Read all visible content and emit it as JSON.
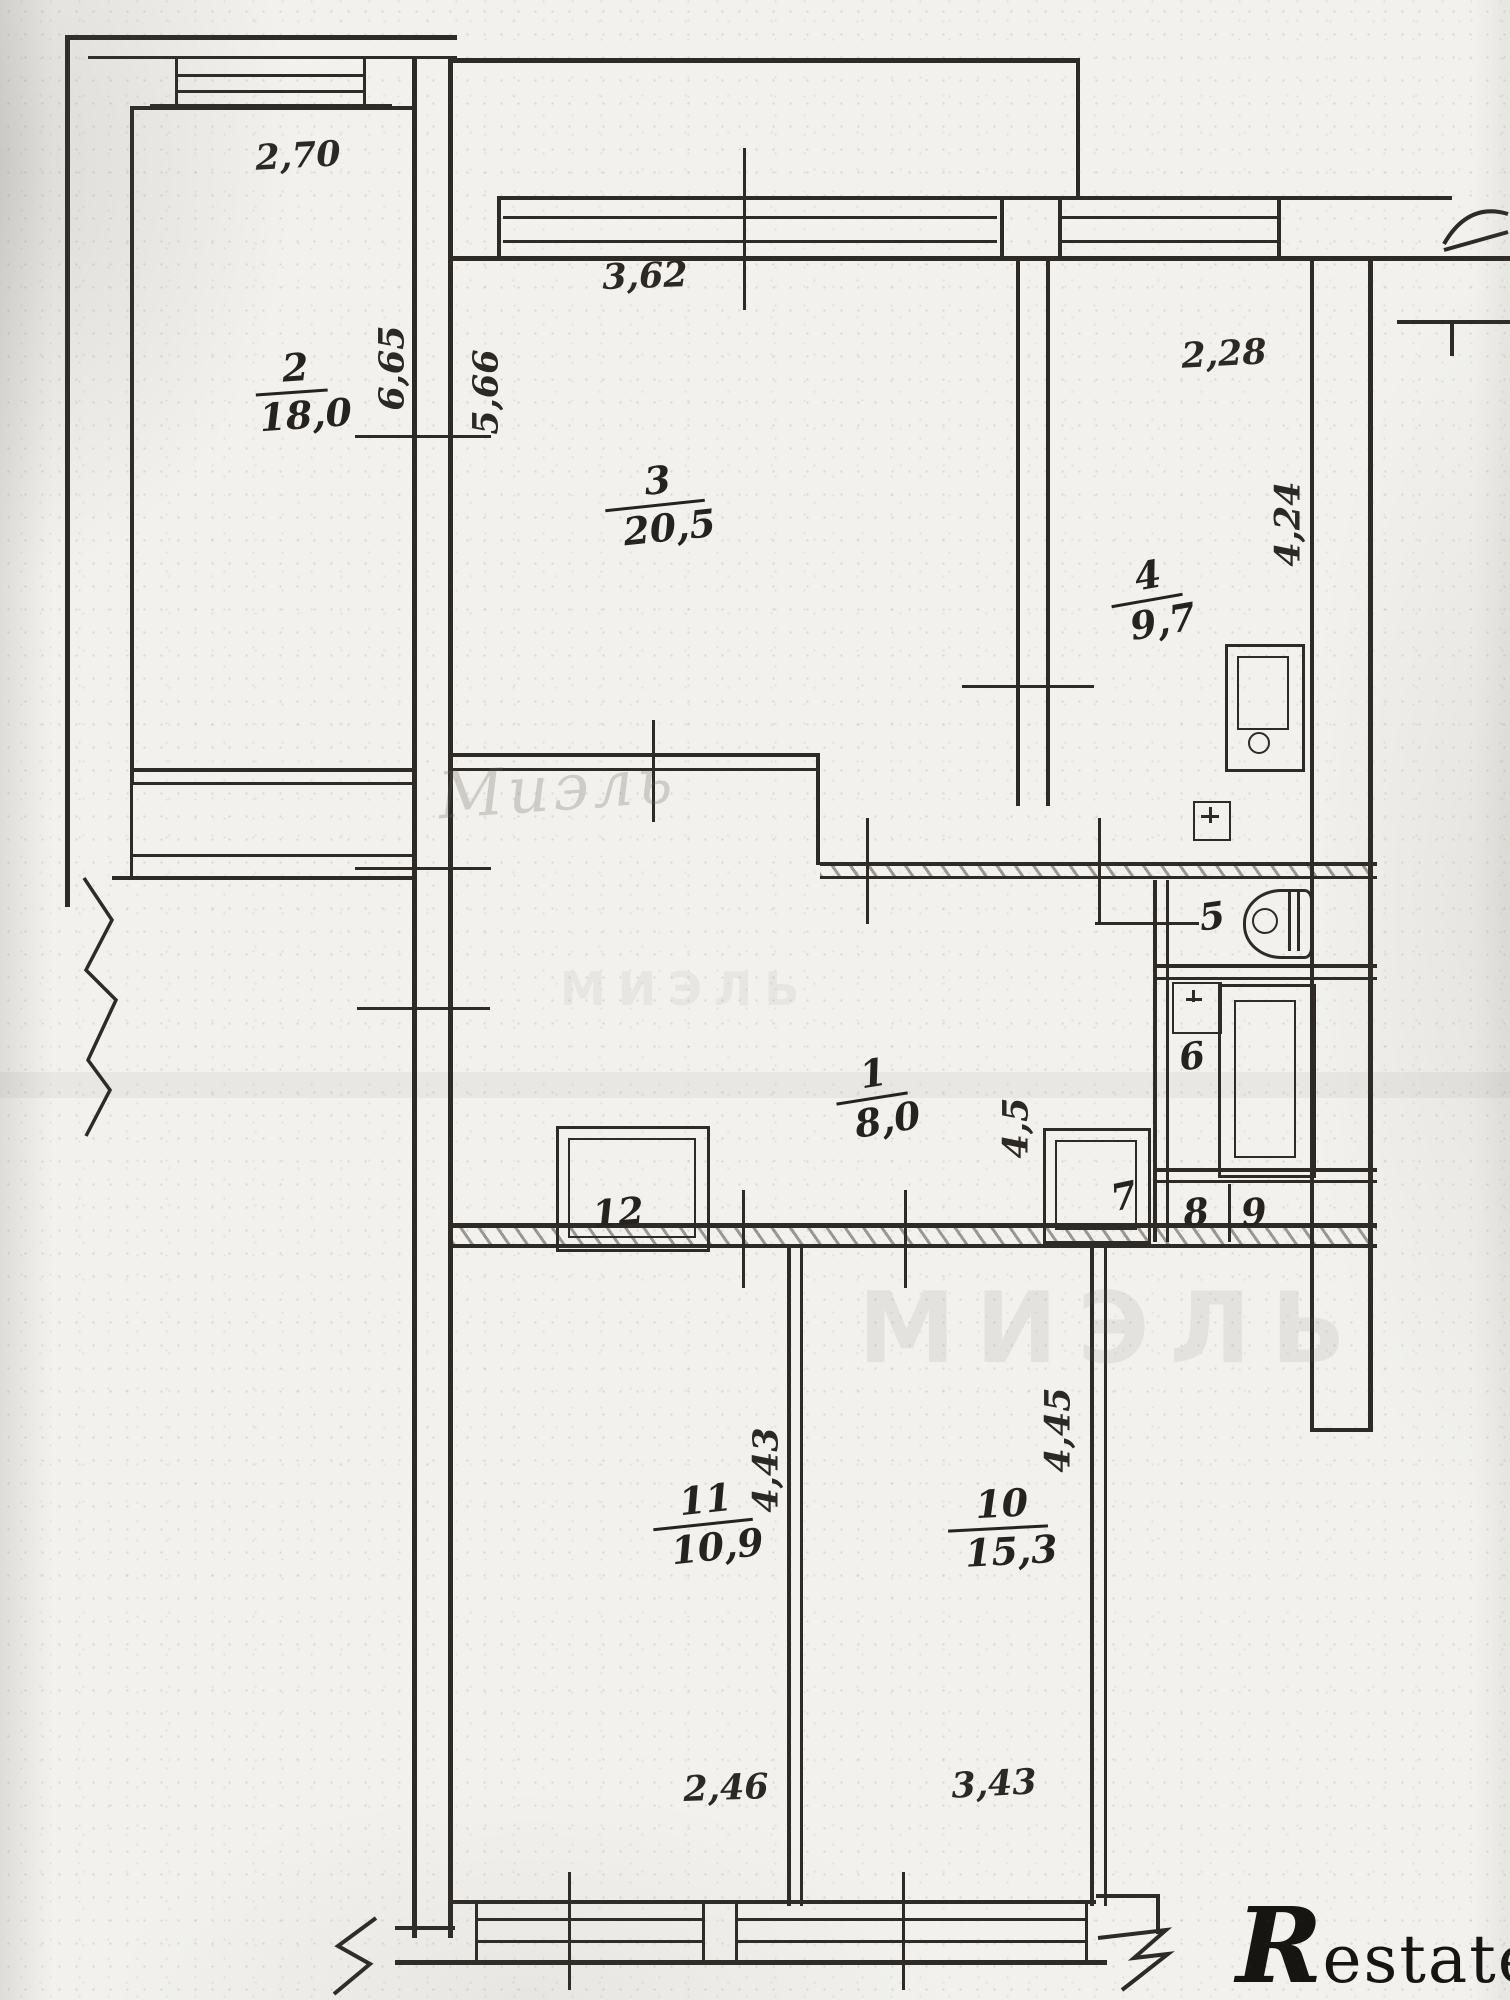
{
  "plan": {
    "kind": "apartment floor plan (scanned, hand-drawn)",
    "colors": {
      "paper": "#f2f1ed",
      "ink": "#2e2b27",
      "watermark": "#6e6962"
    }
  },
  "rooms": [
    {
      "number": "1",
      "area": "8,0"
    },
    {
      "number": "2",
      "area": "18,0"
    },
    {
      "number": "3",
      "area": "20,5"
    },
    {
      "number": "4",
      "area": "9,7"
    },
    {
      "number": "5",
      "area": ""
    },
    {
      "number": "6",
      "area": ""
    },
    {
      "number": "7",
      "area": ""
    },
    {
      "number": "8",
      "area": ""
    },
    {
      "number": "9",
      "area": ""
    },
    {
      "number": "10",
      "area": "15,3"
    },
    {
      "number": "11",
      "area": "10,9"
    },
    {
      "number": "12",
      "area": ""
    }
  ],
  "dims": {
    "room2_width": "2,70",
    "room2_length": "6,65",
    "room3_width": "3,62",
    "room3_length": "5,66",
    "room4_width": "2,28",
    "room4_length": "4,24",
    "hall_side": "4,5",
    "room11_length": "4,43",
    "room11_width": "2,46",
    "room10_length": "4,45",
    "room10_width": "3,43"
  },
  "watermarks": {
    "script": "Миэль",
    "block": "МИЭЛЬ",
    "block_small": "МИЭЛЬ"
  },
  "logo": {
    "initial": "R",
    "rest": "estate"
  }
}
